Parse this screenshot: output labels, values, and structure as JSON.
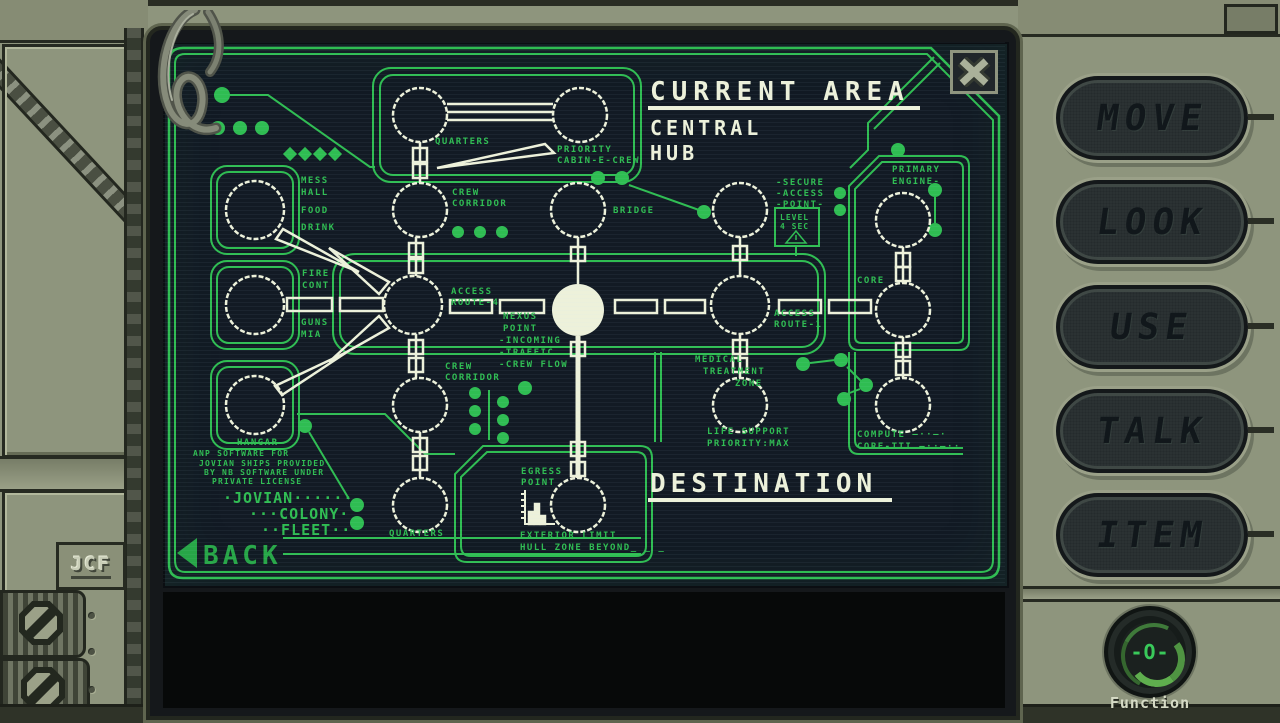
{
  "colors": {
    "green": "#2fbd52",
    "cream": "#edf1da",
    "screen_bg": "#121a24",
    "frame": "#8e957d",
    "back_green": "#27a647"
  },
  "sidebar": {
    "buttons": [
      "MOVE",
      "LOOK",
      "USE",
      "TALK",
      "ITEM"
    ],
    "function_label": "Function",
    "dial_glyph": "-O-"
  },
  "frame": {
    "emboss": "JCF"
  },
  "map": {
    "labels": [
      {
        "name": "current-area-title",
        "x": 487,
        "y": 58,
        "t": "CURRENT AREA",
        "size": 26,
        "ls": 6,
        "color": "#edf1da"
      },
      {
        "name": "current-area-value",
        "x": 487,
        "y": 93,
        "t": "CENTRAL",
        "size": 20,
        "ls": 4,
        "color": "#edf1da"
      },
      {
        "name": "current-area-value",
        "x": 487,
        "y": 118,
        "t": "HUB",
        "size": 20,
        "ls": 4,
        "color": "#edf1da"
      },
      {
        "name": "destination-title",
        "x": 487,
        "y": 450,
        "t": "DESTINATION",
        "size": 26,
        "ls": 5,
        "color": "#edf1da"
      },
      {
        "name": "back-button-label",
        "x": 40,
        "y": 522,
        "t": "BACK",
        "size": 26,
        "ls": 4,
        "color": "#27a647",
        "interactable": "true"
      },
      {
        "name": "label-quarters-top",
        "x": 272,
        "y": 102,
        "t": "QUARTERS"
      },
      {
        "name": "label-priority-cabin",
        "x": 394,
        "y": 110,
        "t": "PRIORITY"
      },
      {
        "name": "label-priority-cabin",
        "x": 394,
        "y": 121,
        "t": "CABIN-E-CREW"
      },
      {
        "name": "label-crew-corridor-top",
        "x": 289,
        "y": 153,
        "t": "CREW"
      },
      {
        "name": "label-crew-corridor-top",
        "x": 289,
        "y": 164,
        "t": "CORRIDOR"
      },
      {
        "name": "label-mess-hall",
        "x": 138,
        "y": 141,
        "t": "MESS"
      },
      {
        "name": "label-mess-hall",
        "x": 138,
        "y": 153,
        "t": "HALL"
      },
      {
        "name": "label-mess-hall",
        "x": 138,
        "y": 171,
        "t": "FOOD"
      },
      {
        "name": "label-mess-hall",
        "x": 138,
        "y": 188,
        "t": "DRINK"
      },
      {
        "name": "label-bridge",
        "x": 450,
        "y": 171,
        "t": "BRIDGE"
      },
      {
        "name": "label-secure-access",
        "x": 613,
        "y": 143,
        "t": "-SECURE"
      },
      {
        "name": "label-secure-access",
        "x": 613,
        "y": 154,
        "t": "-ACCESS"
      },
      {
        "name": "label-secure-access",
        "x": 613,
        "y": 165,
        "t": "-POINT-"
      },
      {
        "name": "label-level-sec",
        "x": 617,
        "y": 178,
        "t": "LEVEL",
        "size": 8,
        "ls": 1
      },
      {
        "name": "label-level-sec",
        "x": 617,
        "y": 187,
        "t": "4 SEC",
        "size": 8,
        "ls": 1
      },
      {
        "name": "label-primary-engine",
        "x": 729,
        "y": 130,
        "t": "PRIMARY"
      },
      {
        "name": "label-primary-engine",
        "x": 729,
        "y": 142,
        "t": "ENGINE-"
      },
      {
        "name": "label-fire-cont",
        "x": 139,
        "y": 234,
        "t": "FIRE"
      },
      {
        "name": "label-fire-cont",
        "x": 139,
        "y": 246,
        "t": "CONT"
      },
      {
        "name": "label-guns-mia",
        "x": 138,
        "y": 283,
        "t": "GUNS"
      },
      {
        "name": "label-guns-mia",
        "x": 138,
        "y": 295,
        "t": "MIA"
      },
      {
        "name": "label-access-route-4",
        "x": 288,
        "y": 252,
        "t": "ACCESS"
      },
      {
        "name": "label-access-route-4",
        "x": 288,
        "y": 263,
        "t": "ROUTE-4"
      },
      {
        "name": "label-nexus-point",
        "x": 340,
        "y": 277,
        "t": "NEXUS"
      },
      {
        "name": "label-nexus-point",
        "x": 340,
        "y": 289,
        "t": "POINT"
      },
      {
        "name": "label-nexus-point",
        "x": 336,
        "y": 301,
        "t": "-INCOMING"
      },
      {
        "name": "label-nexus-point",
        "x": 336,
        "y": 313,
        "t": "-TRAFFIC"
      },
      {
        "name": "label-nexus-point",
        "x": 336,
        "y": 325,
        "t": "-CREW FLOW"
      },
      {
        "name": "label-access-route-1",
        "x": 611,
        "y": 274,
        "t": "ACCESS"
      },
      {
        "name": "label-access-route-1",
        "x": 611,
        "y": 285,
        "t": "ROUTE-1"
      },
      {
        "name": "label-core",
        "x": 694,
        "y": 241,
        "t": "CORE"
      },
      {
        "name": "label-medical",
        "x": 532,
        "y": 320,
        "t": "MEDICAL"
      },
      {
        "name": "label-medical",
        "x": 540,
        "y": 332,
        "t": "TREATMENT"
      },
      {
        "name": "label-medical",
        "x": 572,
        "y": 344,
        "t": "ZONE"
      },
      {
        "name": "label-life-support",
        "x": 544,
        "y": 392,
        "t": "LIFE SUPPORT"
      },
      {
        "name": "label-life-support",
        "x": 544,
        "y": 404,
        "t": "PRIORITY:MAX"
      },
      {
        "name": "label-compute-core",
        "x": 694,
        "y": 395,
        "t": "COMPUTE —··—·"
      },
      {
        "name": "label-compute-core",
        "x": 694,
        "y": 407,
        "t": "CORE-TTI —··—··"
      },
      {
        "name": "label-crew-corridor-mid",
        "x": 282,
        "y": 327,
        "t": "CREW"
      },
      {
        "name": "label-crew-corridor-mid",
        "x": 282,
        "y": 338,
        "t": "CORRIDOR"
      },
      {
        "name": "label-hangar",
        "x": 74,
        "y": 403,
        "t": "HANGAR"
      },
      {
        "name": "label-quarters-bottom",
        "x": 226,
        "y": 494,
        "t": "QUARTERS"
      },
      {
        "name": "label-egress-point",
        "x": 358,
        "y": 432,
        "t": "EGRESS"
      },
      {
        "name": "label-egress-point",
        "x": 358,
        "y": 443,
        "t": "POINT"
      },
      {
        "name": "label-exterior-limit",
        "x": 357,
        "y": 496,
        "t": "EXTERIOR LIMIT"
      },
      {
        "name": "label-exterior-limit",
        "x": 357,
        "y": 508,
        "t": "HULL ZONE BEYOND_ _ _"
      },
      {
        "name": "label-license",
        "x": 30,
        "y": 414,
        "t": "ANP SOFTWARE FOR",
        "size": 8,
        "ls": 1.2
      },
      {
        "name": "label-license",
        "x": 36,
        "y": 424,
        "t": "JOVIAN SHIPS PROVIDED",
        "size": 8,
        "ls": 1.2
      },
      {
        "name": "label-license",
        "x": 41,
        "y": 433,
        "t": "BY NB SOFTWARE UNDER",
        "size": 8,
        "ls": 1.2
      },
      {
        "name": "label-license",
        "x": 49,
        "y": 442,
        "t": "PRIVATE LICENSE",
        "size": 8,
        "ls": 1.2
      },
      {
        "name": "label-jovian-fleet",
        "x": 60,
        "y": 461,
        "t": "·JOVIAN······",
        "size": 15,
        "ls": 1
      },
      {
        "name": "label-jovian-fleet",
        "x": 86,
        "y": 477,
        "t": "···COLONY·",
        "size": 15,
        "ls": 1
      },
      {
        "name": "label-jovian-fleet",
        "x": 98,
        "y": 493,
        "t": "··FLEET··",
        "size": 15,
        "ls": 1
      }
    ]
  }
}
